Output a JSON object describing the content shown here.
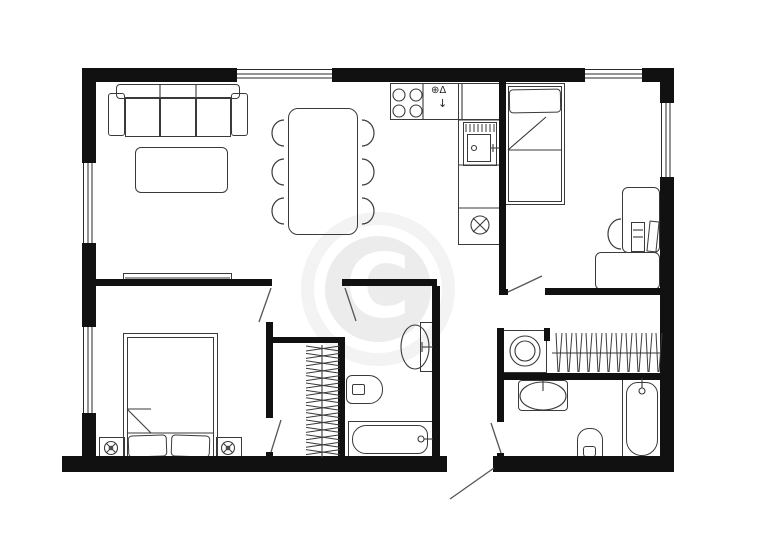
{
  "title": "apartment-floor-plan",
  "colors": {
    "wall": "#111111",
    "line": "#3a3a3a",
    "door": "#555555",
    "watermark_ring": "#f3f3f3",
    "watermark_disc": "#ececec"
  },
  "watermark": {
    "letter": "C",
    "cx": 378,
    "cy": 289,
    "ring_d": 154,
    "disc_d": 106
  },
  "walls": [
    {
      "name": "wall-outer-top",
      "x": 82,
      "y": 68,
      "w": 592,
      "h": 14
    },
    {
      "name": "wall-outer-left",
      "x": 82,
      "y": 68,
      "w": 14,
      "h": 402
    },
    {
      "name": "wall-outer-right",
      "x": 660,
      "y": 68,
      "w": 14,
      "h": 388
    },
    {
      "name": "wall-outer-bottom-left",
      "x": 62,
      "y": 456,
      "w": 385,
      "h": 16
    },
    {
      "name": "wall-outer-bottom-right",
      "x": 493,
      "y": 456,
      "w": 181,
      "h": 16
    },
    {
      "name": "wall-kitchen-divider",
      "x": 499,
      "y": 82,
      "w": 7,
      "h": 213
    },
    {
      "name": "wall-kitchen-divider-stub",
      "x": 499,
      "y": 289,
      "w": 9,
      "h": 6
    },
    {
      "name": "wall-bedroom2-south",
      "x": 545,
      "y": 288,
      "w": 115,
      "h": 7
    },
    {
      "name": "wall-corridor-east",
      "x": 497,
      "y": 328,
      "w": 7,
      "h": 94
    },
    {
      "name": "wall-corridor-east-stub",
      "x": 497,
      "y": 453,
      "w": 7,
      "h": 7
    },
    {
      "name": "wall-washer-post",
      "x": 544,
      "y": 328,
      "w": 6,
      "h": 13
    },
    {
      "name": "wall-laundry-bath-divider",
      "x": 497,
      "y": 373,
      "w": 165,
      "h": 7
    },
    {
      "name": "wall-living-bedroom1",
      "x": 96,
      "y": 279,
      "w": 176,
      "h": 7
    },
    {
      "name": "wall-bath1-north",
      "x": 342,
      "y": 279,
      "w": 95,
      "h": 7
    },
    {
      "name": "wall-bedroom1-east",
      "x": 266,
      "y": 322,
      "w": 7,
      "h": 96
    },
    {
      "name": "wall-bedroom1-east-stub",
      "x": 266,
      "y": 452,
      "w": 7,
      "h": 8
    },
    {
      "name": "wall-closet1-north",
      "x": 266,
      "y": 337,
      "w": 77,
      "h": 6
    },
    {
      "name": "wall-closet1-east",
      "x": 338,
      "y": 337,
      "w": 7,
      "h": 119
    },
    {
      "name": "wall-bath1-east",
      "x": 432,
      "y": 286,
      "w": 8,
      "h": 170
    }
  ],
  "windows": [
    {
      "name": "window-top-living",
      "x": 237,
      "y": 68,
      "w": 95,
      "h": 14,
      "dir": "h"
    },
    {
      "name": "window-top-bedroom2",
      "x": 585,
      "y": 68,
      "w": 57,
      "h": 14,
      "dir": "h"
    },
    {
      "name": "window-left-living",
      "x": 82,
      "y": 163,
      "w": 14,
      "h": 80,
      "dir": "v"
    },
    {
      "name": "window-left-bedroom1",
      "x": 82,
      "y": 327,
      "w": 14,
      "h": 86,
      "dir": "v"
    },
    {
      "name": "window-right-bedroom2",
      "x": 660,
      "y": 103,
      "w": 14,
      "h": 74,
      "dir": "v"
    }
  ],
  "doors": [
    {
      "name": "door-bedroom1",
      "x1": 271,
      "y1": 288,
      "x2": 259,
      "y2": 322
    },
    {
      "name": "door-closet1",
      "x1": 271,
      "y1": 452,
      "x2": 281,
      "y2": 420
    },
    {
      "name": "door-bath1",
      "x1": 345,
      "y1": 288,
      "x2": 356,
      "y2": 321
    },
    {
      "name": "door-bedroom2",
      "x1": 508,
      "y1": 292,
      "x2": 542,
      "y2": 276
    },
    {
      "name": "door-bath2",
      "x1": 501,
      "y1": 453,
      "x2": 491,
      "y2": 423
    },
    {
      "name": "door-entry",
      "x1": 494,
      "y1": 468,
      "x2": 450,
      "y2": 499
    }
  ],
  "furniture": [
    {
      "name": "sofa-back",
      "x": 116,
      "y": 84,
      "w": 124,
      "h": 15,
      "r": "4px"
    },
    {
      "name": "sofa-arm-left",
      "x": 108,
      "y": 93,
      "w": 17,
      "h": 43,
      "r": "3px"
    },
    {
      "name": "sofa-arm-right",
      "x": 231,
      "y": 93,
      "w": 17,
      "h": 43,
      "r": "3px"
    },
    {
      "name": "sofa-seat-1",
      "x": 125,
      "y": 97,
      "w": 35,
      "h": 40
    },
    {
      "name": "sofa-seat-2",
      "x": 160,
      "y": 97,
      "w": 36,
      "h": 40
    },
    {
      "name": "sofa-seat-3",
      "x": 196,
      "y": 97,
      "w": 35,
      "h": 40
    },
    {
      "name": "coffee-table",
      "x": 135,
      "y": 147,
      "w": 93,
      "h": 46,
      "r": "6px"
    },
    {
      "name": "tv-board",
      "x": 123,
      "y": 273,
      "w": 109,
      "h": 9
    },
    {
      "name": "dining-table",
      "x": 288,
      "y": 108,
      "w": 70,
      "h": 127,
      "r": "10px"
    },
    {
      "name": "kitchen-counter-top",
      "x": 390,
      "y": 83,
      "w": 110,
      "h": 37
    },
    {
      "name": "kitchen-counter-col",
      "x": 458,
      "y": 83,
      "w": 42,
      "h": 162
    },
    {
      "name": "kitchen-sink-outer",
      "x": 463,
      "y": 122,
      "w": 34,
      "h": 44
    },
    {
      "name": "kitchen-sink-inner",
      "x": 467,
      "y": 134,
      "w": 24,
      "h": 28
    },
    {
      "name": "bed-single-outer",
      "x": 505,
      "y": 83,
      "w": 60,
      "h": 122
    },
    {
      "name": "bed-single-inner",
      "x": 508,
      "y": 86,
      "w": 54,
      "h": 116
    },
    {
      "name": "pillow-single",
      "x": 509,
      "y": 89,
      "w": 52,
      "h": 24,
      "r": "4px",
      "rot": -1
    },
    {
      "name": "desk-upper",
      "x": 622,
      "y": 187,
      "w": 38,
      "h": 66,
      "r": "6px"
    },
    {
      "name": "desk-lower",
      "x": 595,
      "y": 252,
      "w": 65,
      "h": 38,
      "r": "6px"
    },
    {
      "name": "desk-monitor",
      "x": 631,
      "y": 222,
      "w": 14,
      "h": 30
    },
    {
      "name": "desk-laptop",
      "x": 648,
      "y": 221,
      "w": 10,
      "h": 31,
      "rot": 6
    },
    {
      "name": "bed-double-outer",
      "x": 123,
      "y": 333,
      "w": 95,
      "h": 129
    },
    {
      "name": "bed-double-inner",
      "x": 127,
      "y": 337,
      "w": 87,
      "h": 121
    },
    {
      "name": "pillow-double-left",
      "x": 128,
      "y": 435,
      "w": 39,
      "h": 22,
      "r": "4px",
      "rot": -2
    },
    {
      "name": "pillow-double-right",
      "x": 171,
      "y": 435,
      "w": 39,
      "h": 22,
      "r": "4px",
      "rot": 2
    },
    {
      "name": "nightstand-left",
      "x": 99,
      "y": 437,
      "w": 26,
      "h": 22
    },
    {
      "name": "nightstand-right",
      "x": 216,
      "y": 437,
      "w": 26,
      "h": 22
    },
    {
      "name": "washing-machine",
      "x": 503,
      "y": 330,
      "w": 44,
      "h": 43
    },
    {
      "name": "vanity-sink-right",
      "x": 518,
      "y": 380,
      "w": 50,
      "h": 31,
      "r": "4px"
    },
    {
      "name": "toilet-right-outer",
      "x": 577,
      "y": 428,
      "w": 26,
      "h": 33,
      "r": "12px 12px 5px 5px"
    },
    {
      "name": "toilet-right-tank",
      "x": 583,
      "y": 446,
      "w": 13,
      "h": 11,
      "r": "3px"
    },
    {
      "name": "bathtub-right-outer",
      "x": 622,
      "y": 378,
      "w": 40,
      "h": 83
    },
    {
      "name": "bathtub-right-inner",
      "x": 626,
      "y": 382,
      "w": 32,
      "h": 74,
      "r": "12px 12px 16px 16px"
    },
    {
      "name": "vanity-sink-mid",
      "x": 420,
      "y": 322,
      "w": 13,
      "h": 50
    },
    {
      "name": "toilet-mid-outer",
      "x": 346,
      "y": 375,
      "w": 37,
      "h": 29,
      "r": "6px 14px 14px 6px"
    },
    {
      "name": "toilet-mid-tank",
      "x": 352,
      "y": 384,
      "w": 13,
      "h": 11,
      "r": "2px"
    },
    {
      "name": "bathtub-mid-outer",
      "x": 348,
      "y": 421,
      "w": 85,
      "h": 37
    },
    {
      "name": "bathtub-mid-inner",
      "x": 352,
      "y": 425,
      "w": 76,
      "h": 29,
      "r": "14px 10px 10px 14px"
    }
  ],
  "lines": [
    {
      "name": "sofa-back-div-1",
      "x1": 160,
      "y1": 85,
      "x2": 160,
      "y2": 97
    },
    {
      "name": "sofa-back-div-2",
      "x1": 196,
      "y1": 85,
      "x2": 196,
      "y2": 97
    },
    {
      "name": "tv-board-line",
      "x1": 125,
      "y1": 278,
      "x2": 230,
      "y2": 278
    },
    {
      "name": "counter-div-1",
      "x1": 423,
      "y1": 84,
      "x2": 423,
      "y2": 119
    },
    {
      "name": "counter-div-2",
      "x1": 462,
      "y1": 84,
      "x2": 462,
      "y2": 119
    },
    {
      "name": "counter-div-3",
      "x1": 459,
      "y1": 120,
      "x2": 499,
      "y2": 120
    },
    {
      "name": "counter-div-4",
      "x1": 459,
      "y1": 165,
      "x2": 499,
      "y2": 165
    },
    {
      "name": "counter-div-5",
      "x1": 459,
      "y1": 208,
      "x2": 499,
      "y2": 208
    },
    {
      "name": "kitchen-faucet-line",
      "x1": 491,
      "y1": 148,
      "x2": 499,
      "y2": 148
    },
    {
      "name": "kitchen-faucet-cross",
      "x1": 493,
      "y1": 144,
      "x2": 493,
      "y2": 152
    },
    {
      "name": "single-bed-blanket-line",
      "x1": 508,
      "y1": 150,
      "x2": 562,
      "y2": 150
    },
    {
      "name": "single-bed-fold",
      "x1": 508,
      "y1": 150,
      "x2": 546,
      "y2": 117
    },
    {
      "name": "double-bed-blanket-line",
      "x1": 127,
      "y1": 433,
      "x2": 214,
      "y2": 433
    },
    {
      "name": "double-bed-fold-diag",
      "x1": 127,
      "y1": 409,
      "x2": 151,
      "y2": 433
    },
    {
      "name": "double-bed-fold-top",
      "x1": 127,
      "y1": 409,
      "x2": 151,
      "y2": 409
    },
    {
      "name": "monitor-line-1",
      "x1": 633,
      "y1": 230,
      "x2": 643,
      "y2": 230
    },
    {
      "name": "monitor-line-2",
      "x1": 633,
      "y1": 237,
      "x2": 643,
      "y2": 237
    },
    {
      "name": "closet1-rail",
      "x1": 322,
      "y1": 345,
      "x2": 322,
      "y2": 458
    },
    {
      "name": "closet2-rail",
      "x1": 552,
      "y1": 353,
      "x2": 660,
      "y2": 353
    },
    {
      "name": "tub-mid-faucet-line",
      "x1": 424,
      "y1": 439,
      "x2": 433,
      "y2": 439
    },
    {
      "name": "tub-right-faucet-line",
      "x1": 642,
      "y1": 378,
      "x2": 642,
      "y2": 388
    },
    {
      "name": "sink-mid-faucet-line",
      "x1": 422,
      "y1": 347,
      "x2": 433,
      "y2": 347
    },
    {
      "name": "sink-mid-faucet-tick",
      "x1": 422,
      "y1": 342,
      "x2": 422,
      "y2": 352
    },
    {
      "name": "sink-right-faucet-stem",
      "x1": 543,
      "y1": 381,
      "x2": 543,
      "y2": 391
    },
    {
      "name": "appliance-x-1",
      "x1": 473,
      "y1": 218,
      "x2": 487,
      "y2": 232
    },
    {
      "name": "appliance-x-2",
      "x1": 487,
      "y1": 218,
      "x2": 473,
      "y2": 232
    }
  ],
  "ellipses": [
    {
      "name": "burner-1",
      "cx": 399,
      "cy": 95,
      "rx": 6,
      "ry": 6
    },
    {
      "name": "burner-2",
      "cx": 416,
      "cy": 95,
      "rx": 6,
      "ry": 6
    },
    {
      "name": "burner-3",
      "cx": 399,
      "cy": 111,
      "rx": 6,
      "ry": 6
    },
    {
      "name": "burner-4",
      "cx": 416,
      "cy": 111,
      "rx": 6,
      "ry": 6
    },
    {
      "name": "kitchen-sink-drain",
      "cx": 474,
      "cy": 148,
      "rx": 2.5,
      "ry": 2.5
    },
    {
      "name": "appliance-circle",
      "cx": 480,
      "cy": 225,
      "rx": 9,
      "ry": 9
    },
    {
      "name": "washer-drum-outer",
      "cx": 525,
      "cy": 351,
      "rx": 15,
      "ry": 15
    },
    {
      "name": "washer-drum-inner",
      "cx": 525,
      "cy": 351,
      "rx": 10,
      "ry": 10
    },
    {
      "name": "sink-right-basin",
      "cx": 543,
      "cy": 396,
      "rx": 23,
      "ry": 14
    },
    {
      "name": "sink-mid-basin",
      "cx": 415,
      "cy": 347,
      "rx": 14,
      "ry": 22
    },
    {
      "name": "tub-mid-faucet-knob",
      "cx": 421,
      "cy": 439,
      "rx": 3,
      "ry": 3
    },
    {
      "name": "tub-right-faucet-knob",
      "cx": 642,
      "cy": 391,
      "rx": 3,
      "ry": 3
    }
  ],
  "chairs": [
    {
      "name": "dining-chair-left-1",
      "cx": 284,
      "cy": 133,
      "rx": 12,
      "ry": 13,
      "sweep": 0
    },
    {
      "name": "dining-chair-left-2",
      "cx": 284,
      "cy": 172,
      "rx": 12,
      "ry": 13,
      "sweep": 0
    },
    {
      "name": "dining-chair-left-3",
      "cx": 284,
      "cy": 211,
      "rx": 12,
      "ry": 13,
      "sweep": 0
    },
    {
      "name": "dining-chair-right-1",
      "cx": 362,
      "cy": 133,
      "rx": 12,
      "ry": 13,
      "sweep": 1
    },
    {
      "name": "dining-chair-right-2",
      "cx": 362,
      "cy": 172,
      "rx": 12,
      "ry": 13,
      "sweep": 1
    },
    {
      "name": "dining-chair-right-3",
      "cx": 362,
      "cy": 211,
      "rx": 12,
      "ry": 13,
      "sweep": 1
    },
    {
      "name": "desk-chair",
      "cx": 621,
      "cy": 234,
      "rx": 13,
      "ry": 15,
      "sweep": 0
    }
  ],
  "lamps": [
    {
      "name": "lamp-left",
      "cx": 111,
      "cy": 448
    },
    {
      "name": "lamp-right",
      "cx": 228,
      "cy": 448
    }
  ],
  "hangers": {
    "closet1": {
      "axis": "h",
      "x1": 306,
      "x2": 340,
      "y_start": 348,
      "count": 15,
      "step": 7.4
    },
    "closet2": {
      "axis": "v",
      "y1": 333,
      "y2": 372,
      "x_start": 556,
      "count": 11,
      "step": 10
    }
  },
  "glyphs": [
    {
      "name": "kitchen-tap-symbol",
      "x": 431,
      "y": 86,
      "size": 10,
      "text": "⊕Δ"
    },
    {
      "name": "kitchen-arrow-symbol",
      "x": 438,
      "y": 98,
      "size": 11,
      "text": "↓"
    }
  ]
}
